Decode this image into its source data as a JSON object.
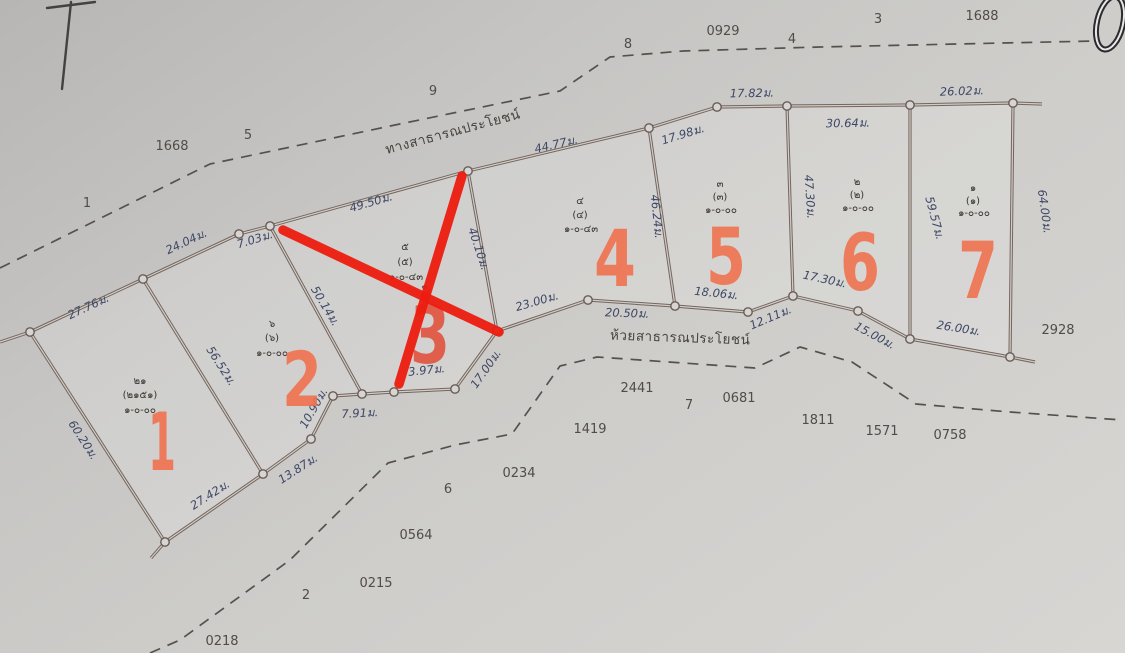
{
  "road_label": "ทางสาธารณประโยชน์",
  "stream_label": "ห้วยสาธารณประโยชน์",
  "plots": [
    {
      "overlay_number": "1",
      "deed": [
        "๒๑",
        "(๒๑๕๑)",
        "๑-๐-๐๐"
      ]
    },
    {
      "overlay_number": "2",
      "deed": [
        "๖",
        "(๖)",
        "๑-๐-๐๐"
      ]
    },
    {
      "overlay_number": "3",
      "deed": [
        "๕",
        "(๕)",
        "๑-๐-๔๓"
      ],
      "deed_extra": "๑๖",
      "crossed_out": true
    },
    {
      "overlay_number": "4",
      "deed": [
        "๔",
        "(๔)",
        "๑-๐-๔๓"
      ]
    },
    {
      "overlay_number": "5",
      "deed": [
        "๓",
        "(๓)",
        "๑-๐-๐๐"
      ]
    },
    {
      "overlay_number": "6",
      "deed": [
        "๒",
        "(๒)",
        "๑-๐-๐๐"
      ]
    },
    {
      "overlay_number": "7",
      "deed": [
        "๑",
        "(๑)",
        "๑-๐-๐๐"
      ]
    }
  ],
  "dimensions": [
    "27.76ม.",
    "24.04ม.",
    "7.03ม.",
    "49.50ม.",
    "44.77ม.",
    "17.98ม.",
    "17.82ม.",
    "30.64ม.",
    "26.02ม.",
    "60.20ม.",
    "27.42ม.",
    "13.87ม.",
    "10.90ม.",
    "7.91ม.",
    "3.97ม.",
    "17.00ม.",
    "23.00ม.",
    "20.50ม.",
    "18.06ม.",
    "12.11ม.",
    "17.30ม.",
    "15.00ม.",
    "26.00ม.",
    "56.52ม.",
    "50.14ม.",
    "40.10ม.",
    "46.24ม.",
    "47.30ม.",
    "59.57ม.",
    "64.00ม."
  ],
  "survey_numbers": [
    "1668",
    "5",
    "9",
    "1",
    "8",
    "0929",
    "4",
    "3",
    "1688",
    "2928",
    "2441",
    "7",
    "0681",
    "1419",
    "1811",
    "1571",
    "0758",
    "0234",
    "6",
    "0564",
    "0215",
    "2",
    "0218"
  ],
  "colors": {
    "paper": "#cccbc9",
    "boundary_ink": "#75655c",
    "dimension_ink": "#3d4766",
    "overlay_orange": "#f1704c",
    "overlay_orange_plot3": "#e2503a",
    "cross_red": "#ee1c10"
  }
}
